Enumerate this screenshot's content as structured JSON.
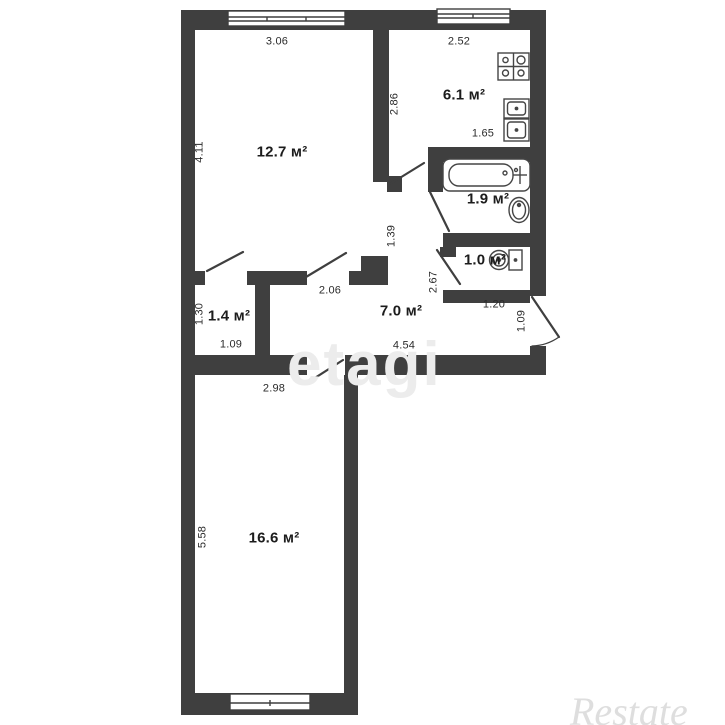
{
  "plan_type": "apartment-floor-plan",
  "rooms": {
    "living1": {
      "area": "12.7 м²"
    },
    "kitchen": {
      "area": "6.1 м²"
    },
    "bath": {
      "area": "1.9 м²"
    },
    "wc": {
      "area": "1.0 м²"
    },
    "hall": {
      "area": "7.0 м²"
    },
    "closet": {
      "area": "1.4 м²"
    },
    "living2": {
      "area": "16.6 м²"
    }
  },
  "dims": {
    "living1_width": "3.06",
    "living1_height": "4.11",
    "kitchen_width": "2.52",
    "kitchen_height": "2.86",
    "kitchen_counter": "1.65",
    "hall_top": "2.06",
    "hall_bottom": "4.54",
    "corridor_height": "1.39",
    "corridor_right": "2.67",
    "wc_width": "1.20",
    "entrance_width": "1.09",
    "closet_height": "1.30",
    "closet_width": "1.09",
    "living2_width": "2.98",
    "living2_height": "5.58"
  },
  "watermarks": {
    "center": "etagi",
    "corner": "Restate"
  },
  "colors": {
    "wall": "#3f3f3f",
    "background": "#ffffff",
    "text": "#2b2b2b",
    "watermark_center": "#ececec",
    "watermark_corner": "#c9c9c9"
  }
}
